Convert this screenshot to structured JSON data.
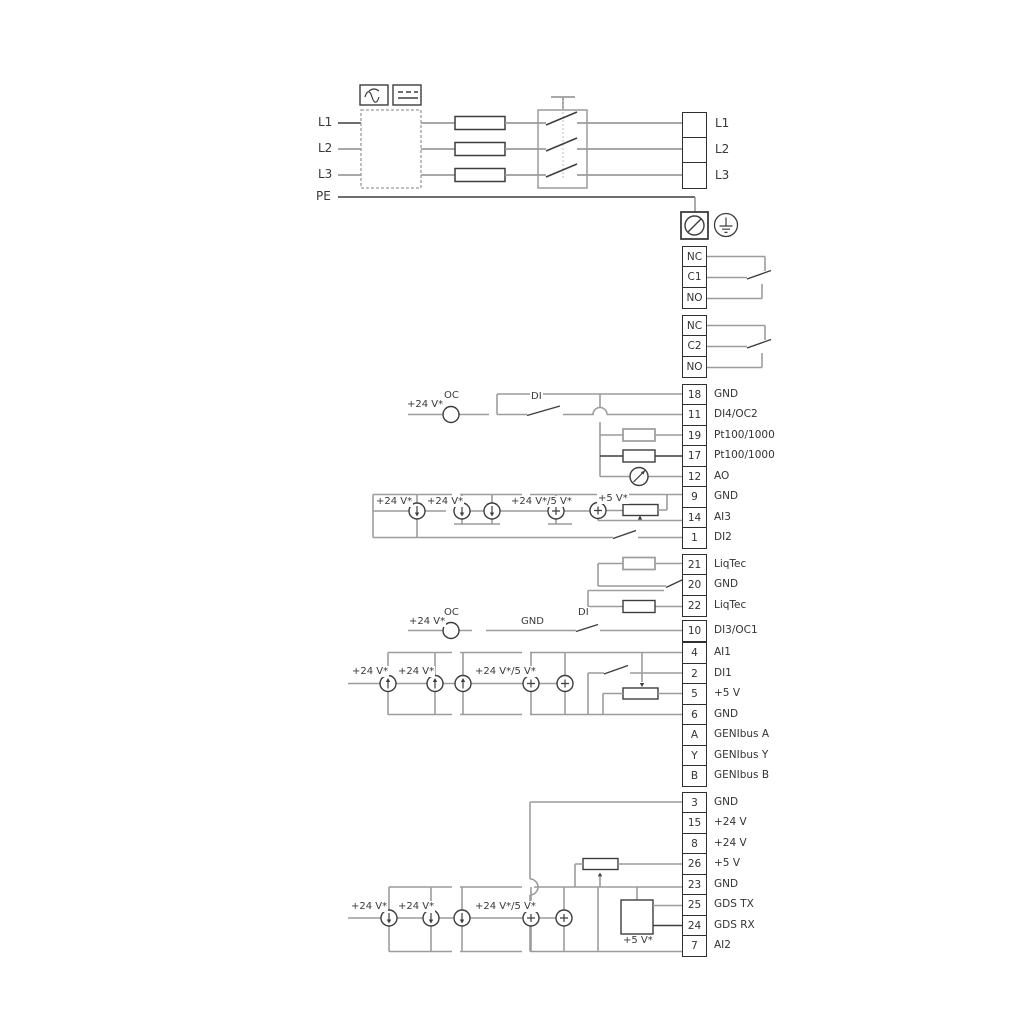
{
  "mains": {
    "left": [
      "L1",
      "L2",
      "L3"
    ],
    "pe": "PE",
    "right": [
      "L1",
      "L2",
      "L3"
    ]
  },
  "relay1": [
    {
      "label": "NC"
    },
    {
      "label": "C1"
    },
    {
      "label": "NO"
    }
  ],
  "relay2": [
    {
      "label": "NC"
    },
    {
      "label": "C2"
    },
    {
      "label": "NO"
    }
  ],
  "io1": [
    {
      "num": "18",
      "label": "GND"
    },
    {
      "num": "11",
      "label": "DI4/OC2"
    },
    {
      "num": "19",
      "label": "Pt100/1000"
    },
    {
      "num": "17",
      "label": "Pt100/1000"
    },
    {
      "num": "12",
      "label": "AO"
    },
    {
      "num": "9",
      "label": "GND"
    },
    {
      "num": "14",
      "label": "AI3"
    },
    {
      "num": "1",
      "label": "DI2"
    }
  ],
  "liqtec": [
    {
      "num": "21",
      "label": "LiqTec"
    },
    {
      "num": "20",
      "label": "GND"
    },
    {
      "num": "22",
      "label": "LiqTec"
    }
  ],
  "io2": [
    {
      "num": "10",
      "label": "DI3/OC1"
    },
    {
      "num": "4",
      "label": "AI1"
    },
    {
      "num": "2",
      "label": "DI1"
    },
    {
      "num": "5",
      "label": "+5 V"
    },
    {
      "num": "6",
      "label": "GND"
    },
    {
      "num": "A",
      "label": "GENIbus A"
    },
    {
      "num": "Y",
      "label": "GENIbus Y"
    },
    {
      "num": "B",
      "label": "GENIbus B"
    }
  ],
  "io3": [
    {
      "num": "3",
      "label": "GND"
    },
    {
      "num": "15",
      "label": "+24 V"
    },
    {
      "num": "8",
      "label": "+24 V"
    },
    {
      "num": "26",
      "label": "+5 V"
    },
    {
      "num": "23",
      "label": "GND"
    },
    {
      "num": "25",
      "label": "GDS TX"
    },
    {
      "num": "24",
      "label": "GDS RX"
    },
    {
      "num": "7",
      "label": "AI2"
    }
  ],
  "sec11": {
    "v": "+24 V*",
    "oc": "OC",
    "di": "DI"
  },
  "ai3": {
    "v1": "+24 V*",
    "v2": "+24 V*",
    "v3": "+24 V*/5 V*",
    "v4": "+5 V*"
  },
  "sec10": {
    "v": "+24 V*",
    "oc": "OC",
    "gnd": "GND",
    "di": "DI"
  },
  "ai1": {
    "v1": "+24 V*",
    "v2": "+24 V*",
    "v3": "+24 V*/5 V*"
  },
  "ai2": {
    "v1": "+24 V*",
    "v2": "+24 V*",
    "v3": "+24 V*/5 V*",
    "v4": "+5 V*"
  },
  "colors": {
    "wire_gray": "#9c9c9c",
    "wire_dark": "#3d3d3d",
    "text": "#333333"
  }
}
